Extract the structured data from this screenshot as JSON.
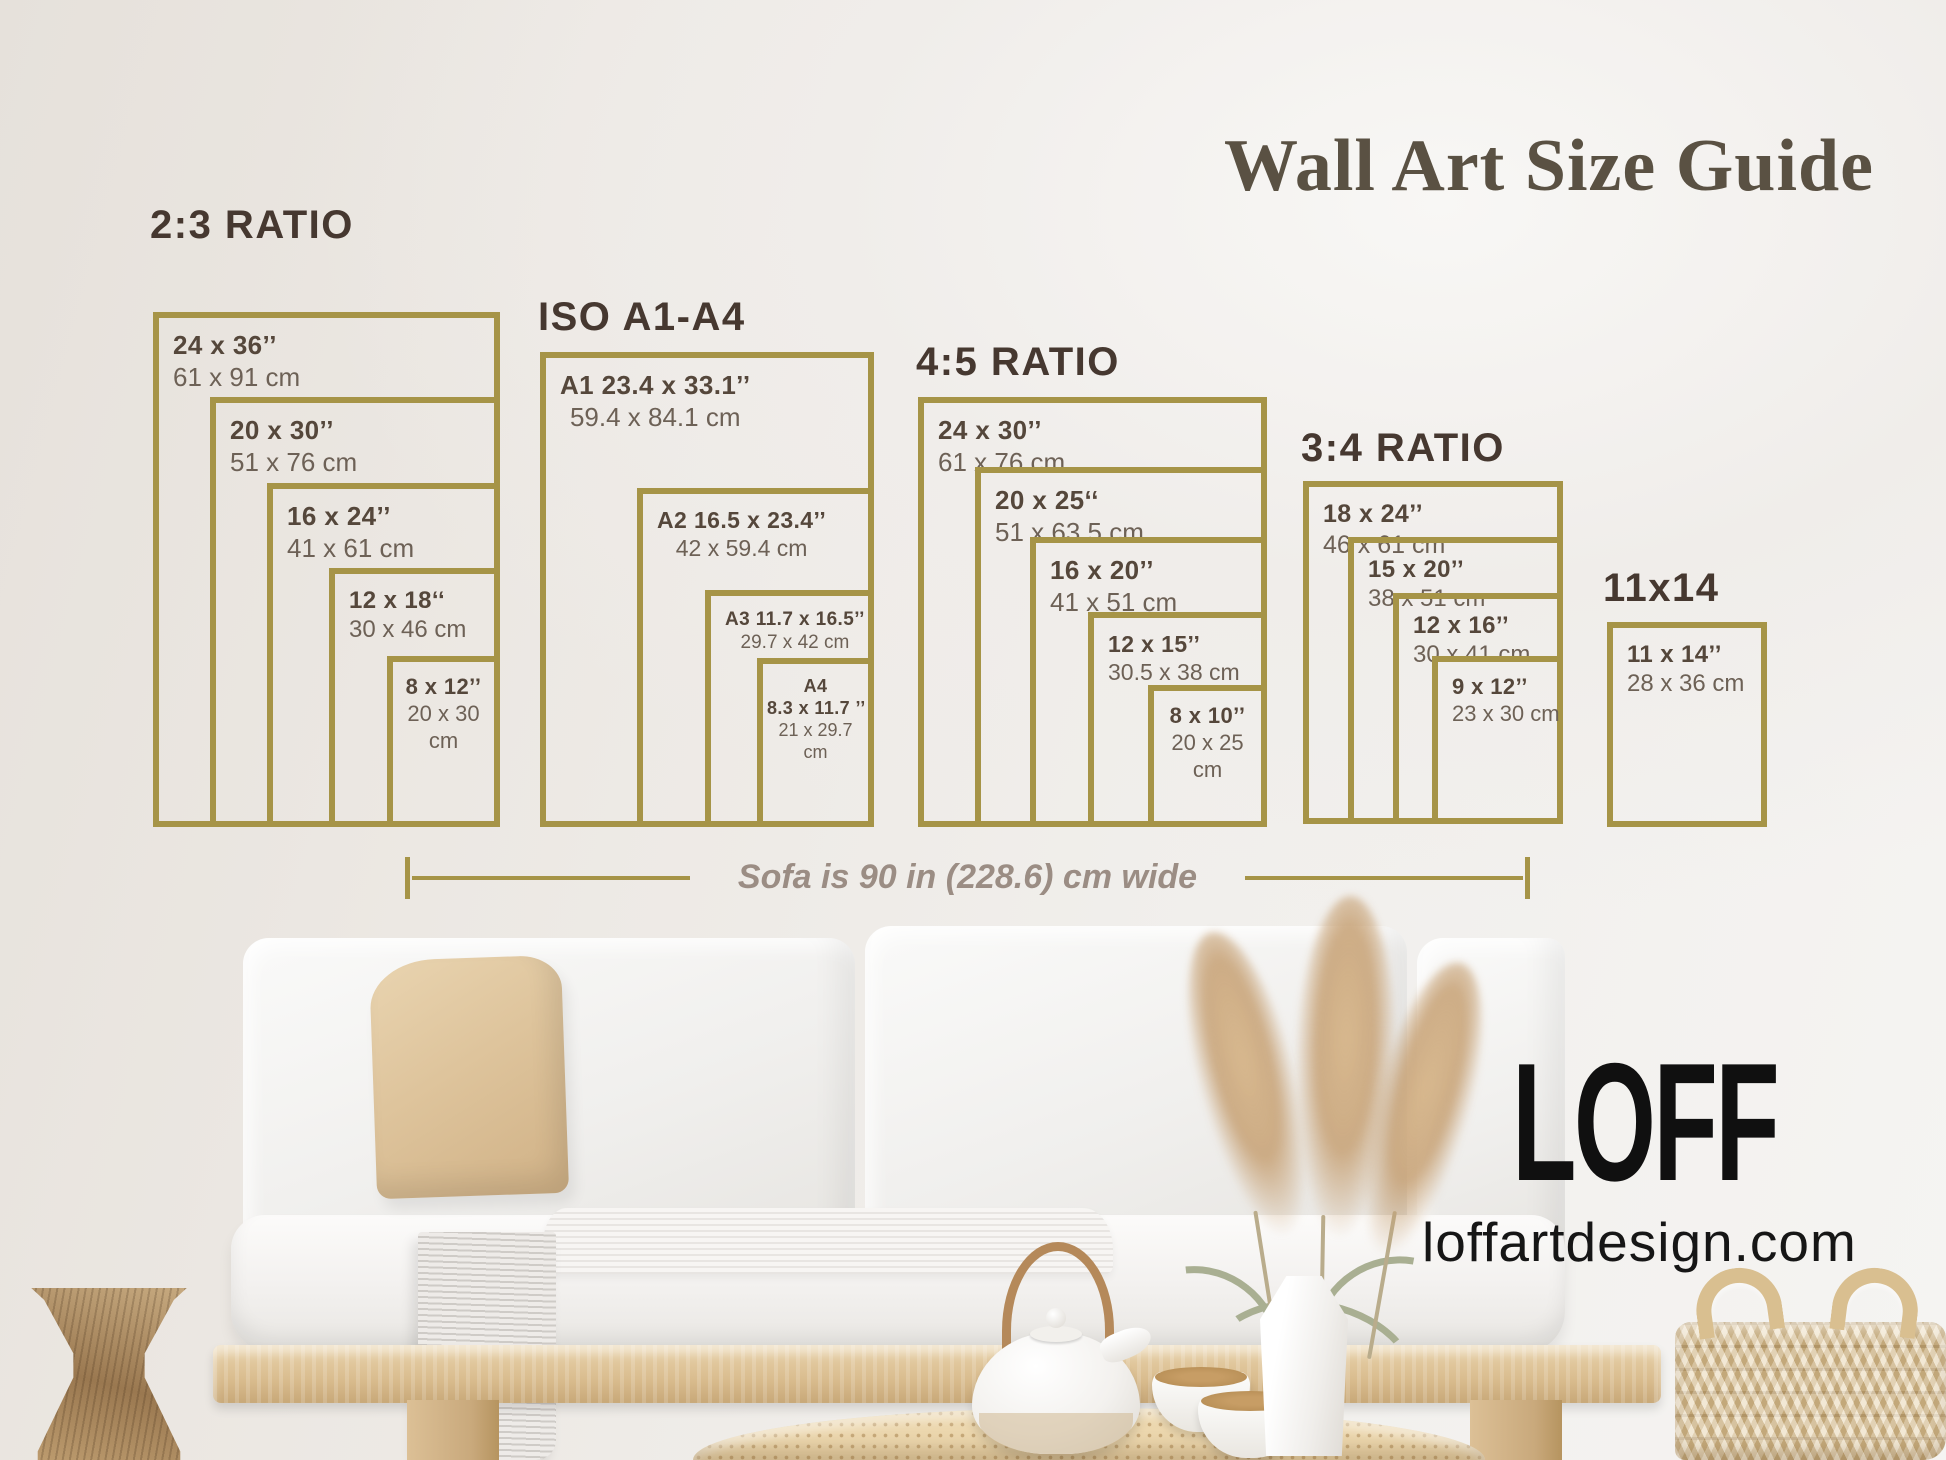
{
  "title": "Wall Art Size Guide",
  "note": {
    "text": "Sofa is 90 in (228.6) cm wide"
  },
  "brand": {
    "logo": "LOFF",
    "website": "loffartdesign.com"
  },
  "colors": {
    "gold": "#a69447",
    "heading": "#463830",
    "lbl-bold": "#55473b",
    "lbl-sub": "#6d6156",
    "title-col": "#5a5143",
    "note-col": "#9b8d84"
  },
  "sections": [
    {
      "heading": "2:3 RATIO",
      "hx": 150,
      "hy": 203,
      "right": 500,
      "bottom": 827,
      "frames": [
        {
          "bold": "24 x 36’’",
          "sub": "61 x 91 cm",
          "left": 153,
          "top": 312,
          "fs": 26,
          "align": "left"
        },
        {
          "bold": "20 x 30’’",
          "sub": "51 x 76 cm",
          "left": 210,
          "top": 397,
          "fs": 26,
          "align": "left"
        },
        {
          "bold": "16 x 24’’",
          "sub": "41 x 61 cm",
          "left": 267,
          "top": 483,
          "fs": 26,
          "align": "left"
        },
        {
          "bold": "12 x 18‘‘",
          "sub": "30 x 46 cm",
          "left": 329,
          "top": 568,
          "fs": 24,
          "align": "left"
        },
        {
          "bold": "8 x 12’’",
          "sub": [
            "20 x 30",
            "cm"
          ],
          "left": 387,
          "top": 656,
          "fs": 22,
          "align": "center"
        }
      ]
    },
    {
      "heading": "ISO A1-A4",
      "hx": 538,
      "hy": 295,
      "right": 874,
      "bottom": 827,
      "frames": [
        {
          "bold": "A1 23.4 x 33.1’’",
          "sub": "59.4 x 84.1 cm",
          "left": 540,
          "top": 352,
          "fs": 26,
          "align": "mixed"
        },
        {
          "bold": "A2 16.5 x 23.4’’",
          "sub": "42 x 59.4 cm",
          "left": 637,
          "top": 488,
          "fs": 23,
          "align": "mixed"
        },
        {
          "bold": "A3 11.7 x 16.5’’",
          "sub": "29.7 x 42 cm",
          "left": 705,
          "top": 590,
          "fs": 19,
          "align": "mixed"
        },
        {
          "bold": [
            "A4",
            "8.3 x 11.7 ’’"
          ],
          "sub": [
            "21 x 29.7",
            "cm"
          ],
          "left": 757,
          "top": 658,
          "fs": 18,
          "align": "center"
        }
      ]
    },
    {
      "heading": "4:5 RATIO",
      "hx": 916,
      "hy": 340,
      "right": 1267,
      "bottom": 827,
      "frames": [
        {
          "bold": "24 x 30’’",
          "sub": "61 x 76 cm",
          "left": 918,
          "top": 397,
          "fs": 26,
          "align": "left"
        },
        {
          "bold": "20 x 25‘‘",
          "sub": "51 x 63.5 cm",
          "left": 975,
          "top": 467,
          "fs": 26,
          "align": "left"
        },
        {
          "bold": "16 x 20’’",
          "sub": "41 x 51 cm",
          "left": 1030,
          "top": 537,
          "fs": 26,
          "align": "left"
        },
        {
          "bold": "12 x 15’’",
          "sub": "30.5 x 38 cm",
          "left": 1088,
          "top": 612,
          "fs": 23,
          "align": "left"
        },
        {
          "bold": "8 x 10’’",
          "sub": [
            "20 x 25",
            "cm"
          ],
          "left": 1148,
          "top": 685,
          "fs": 22,
          "align": "center"
        }
      ]
    },
    {
      "heading": "3:4 RATIO",
      "hx": 1301,
      "hy": 426,
      "right": 1563,
      "bottom": 824,
      "frames": [
        {
          "bold": "18 x 24’’",
          "sub": "46 x 61 cm",
          "left": 1303,
          "top": 481,
          "fs": 25,
          "align": "left"
        },
        {
          "bold": "15 x 20’’",
          "sub": "38 x 51 cm",
          "left": 1348,
          "top": 537,
          "fs": 24,
          "align": "left"
        },
        {
          "bold": "12 x 16’’",
          "sub": "30 x 41 cm",
          "left": 1393,
          "top": 593,
          "fs": 24,
          "align": "left"
        },
        {
          "bold": "9 x 12’’",
          "sub": "23 x 30 cm",
          "left": 1432,
          "top": 656,
          "fs": 22,
          "align": "left"
        }
      ]
    },
    {
      "heading": "11x14",
      "hx": 1603,
      "hy": 566,
      "right": 1767,
      "bottom": 827,
      "frames": [
        {
          "bold": "11 x 14’’",
          "sub": "28 x 36 cm",
          "left": 1607,
          "top": 622,
          "fs": 24,
          "align": "left"
        }
      ]
    }
  ]
}
